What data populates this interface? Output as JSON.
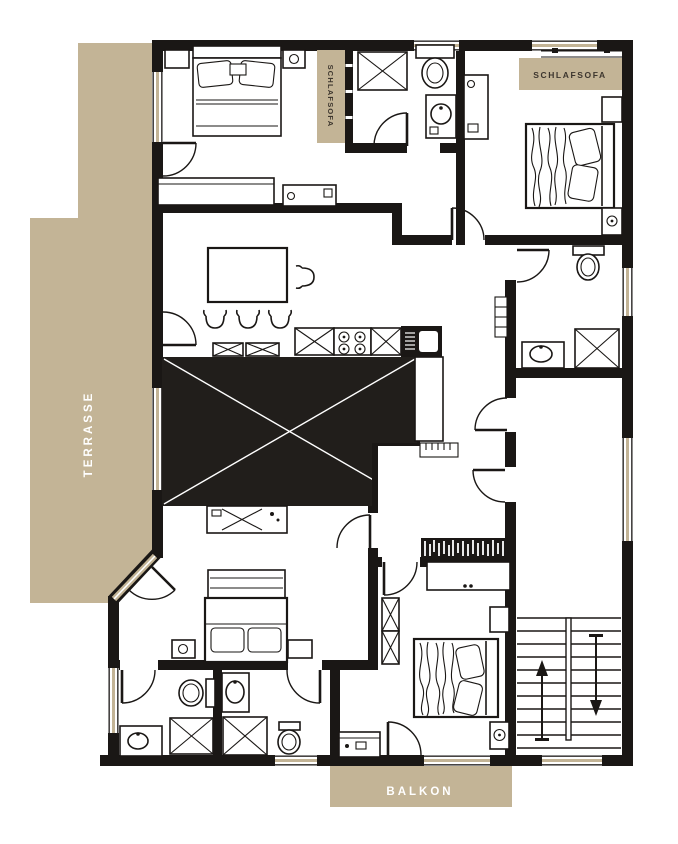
{
  "labels": {
    "terrace": "TERRASSE",
    "balcony": "BALKON",
    "sleepsofa_vertical": "SCHLAFSOFA",
    "sleepsofa_horizontal": "SCHLAFSOFA"
  },
  "colors": {
    "wall": "#1a1715",
    "void": "#211e1b",
    "outdoor": "#c3b496",
    "paper": "#ffffff",
    "label_light": "#ffffff",
    "label_dark": "#3d362e"
  }
}
